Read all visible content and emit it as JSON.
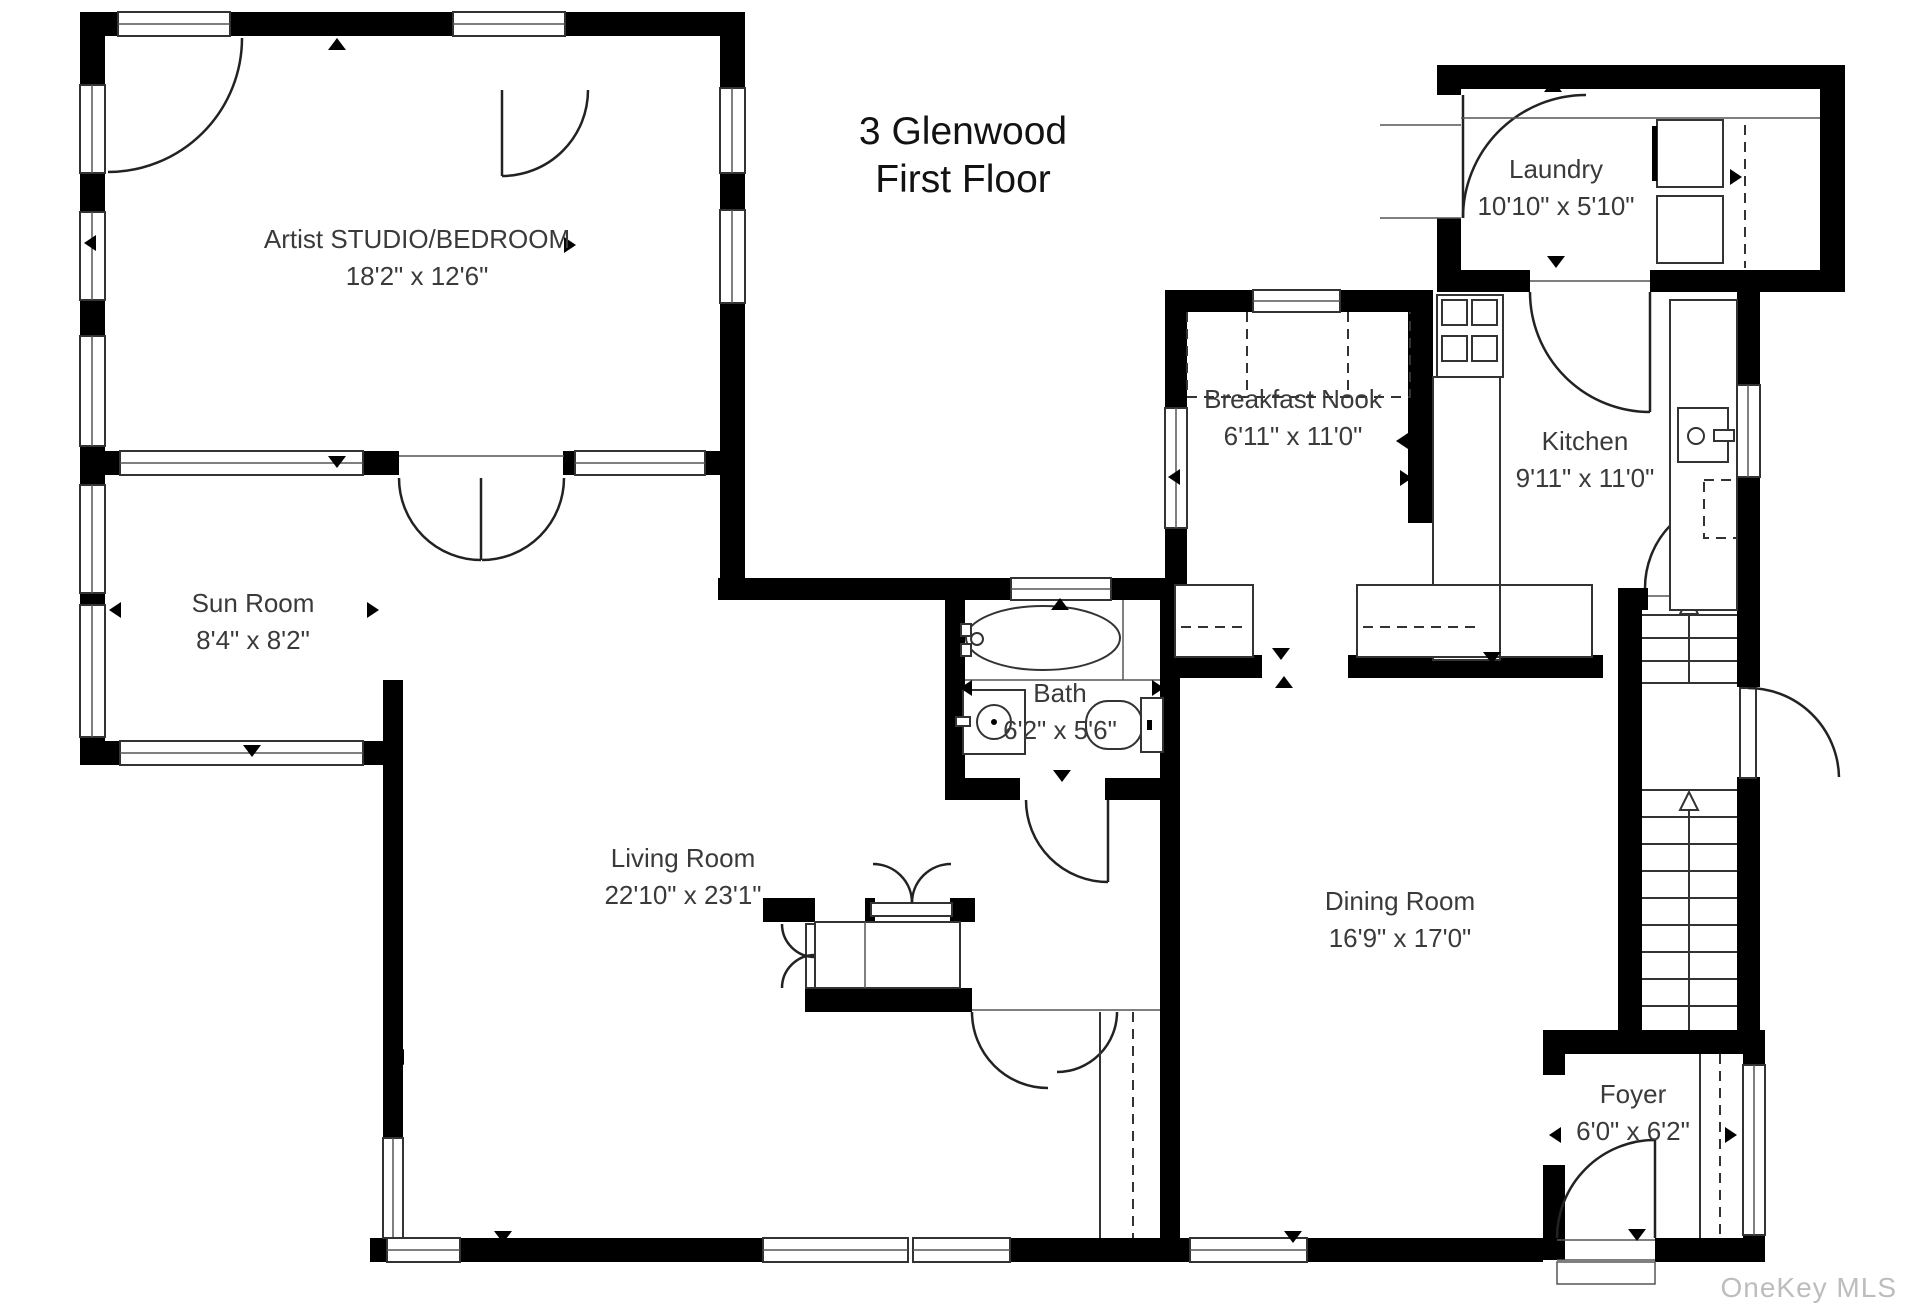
{
  "title": {
    "line1": "3 Glenwood",
    "line2": "First Floor"
  },
  "watermark": "OneKey MLS",
  "rooms": [
    {
      "id": "artist-studio",
      "name": "Artist STUDIO/BEDROOM",
      "dims": "18'2\" x 12'6\""
    },
    {
      "id": "sun-room",
      "name": "Sun Room",
      "dims": "8'4\" x 8'2\""
    },
    {
      "id": "laundry",
      "name": "Laundry",
      "dims": "10'10\" x 5'10\""
    },
    {
      "id": "breakfast-nook",
      "name": "Breakfast Nook",
      "dims": "6'11\" x 11'0\""
    },
    {
      "id": "kitchen",
      "name": "Kitchen",
      "dims": "9'11\" x 11'0\""
    },
    {
      "id": "bath",
      "name": "Bath",
      "dims": "6'2\" x 5'6\""
    },
    {
      "id": "living-room",
      "name": "Living Room",
      "dims": "22'10\" x 23'1\""
    },
    {
      "id": "dining-room",
      "name": "Dining Room",
      "dims": "16'9\" x 17'0\""
    },
    {
      "id": "foyer",
      "name": "Foyer",
      "dims": "6'0\" x 6'2\""
    }
  ],
  "colors": {
    "wall": "#000000",
    "line": "#333333",
    "label": "#3a3a3a",
    "watermark": "#bdbdbd"
  }
}
